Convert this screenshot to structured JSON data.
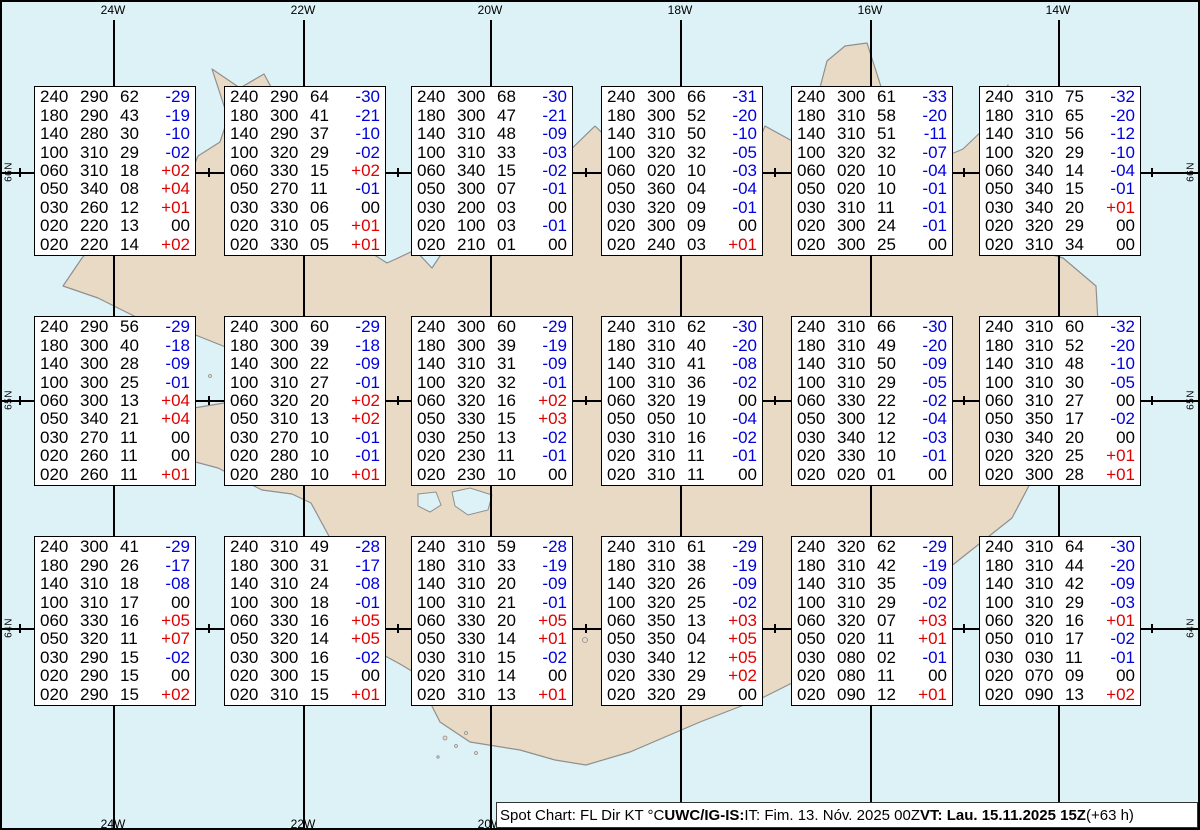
{
  "title": "Spot Chart Iceland",
  "colors": {
    "sea": "#ddf2f7",
    "land": "#e8dac5",
    "coast": "#8f8f8f",
    "grid": "#000000",
    "temp_negative": "#0000dd",
    "temp_positive": "#e00000",
    "temp_zero": "#000000"
  },
  "grid": {
    "meridians": [
      {
        "label": "24W",
        "x": 113
      },
      {
        "label": "22W",
        "x": 303
      },
      {
        "label": "20W",
        "x": 490
      },
      {
        "label": "18W",
        "x": 680
      },
      {
        "label": "16W",
        "x": 870
      },
      {
        "label": "14W",
        "x": 1058
      }
    ],
    "parallels": [
      {
        "label": "66N",
        "y": 172
      },
      {
        "label": "65N",
        "y": 400
      },
      {
        "label": "64N",
        "y": 628
      }
    ],
    "minor_tick_x": [
      19,
      208,
      397,
      585,
      774,
      963,
      1151
    ]
  },
  "columns": [
    "FL",
    "Dir",
    "KT",
    "°C"
  ],
  "boxes": [
    {
      "rows": [
        [
          "240",
          "290",
          "62",
          "-29"
        ],
        [
          "180",
          "290",
          "43",
          "-19"
        ],
        [
          "140",
          "280",
          "30",
          "-10"
        ],
        [
          "100",
          "310",
          "29",
          "-02"
        ],
        [
          "060",
          "310",
          "18",
          "+02"
        ],
        [
          "050",
          "340",
          "08",
          "+04"
        ],
        [
          "030",
          "260",
          "12",
          "+01"
        ],
        [
          "020",
          "220",
          "13",
          "00"
        ],
        [
          "020",
          "220",
          "14",
          "+02"
        ]
      ]
    },
    {
      "rows": [
        [
          "240",
          "290",
          "64",
          "-30"
        ],
        [
          "180",
          "300",
          "41",
          "-21"
        ],
        [
          "140",
          "290",
          "37",
          "-10"
        ],
        [
          "100",
          "320",
          "29",
          "-02"
        ],
        [
          "060",
          "330",
          "15",
          "+02"
        ],
        [
          "050",
          "270",
          "11",
          "-01"
        ],
        [
          "030",
          "330",
          "06",
          "00"
        ],
        [
          "020",
          "310",
          "05",
          "+01"
        ],
        [
          "020",
          "330",
          "05",
          "+01"
        ]
      ]
    },
    {
      "rows": [
        [
          "240",
          "300",
          "68",
          "-30"
        ],
        [
          "180",
          "300",
          "47",
          "-21"
        ],
        [
          "140",
          "310",
          "48",
          "-09"
        ],
        [
          "100",
          "310",
          "33",
          "-03"
        ],
        [
          "060",
          "340",
          "15",
          "-02"
        ],
        [
          "050",
          "300",
          "07",
          "-01"
        ],
        [
          "030",
          "200",
          "03",
          "00"
        ],
        [
          "020",
          "100",
          "03",
          "-01"
        ],
        [
          "020",
          "210",
          "01",
          "00"
        ]
      ]
    },
    {
      "rows": [
        [
          "240",
          "300",
          "66",
          "-31"
        ],
        [
          "180",
          "300",
          "52",
          "-20"
        ],
        [
          "140",
          "310",
          "50",
          "-10"
        ],
        [
          "100",
          "320",
          "32",
          "-05"
        ],
        [
          "060",
          "020",
          "10",
          "-03"
        ],
        [
          "050",
          "360",
          "04",
          "-04"
        ],
        [
          "030",
          "320",
          "09",
          "-01"
        ],
        [
          "020",
          "300",
          "09",
          "00"
        ],
        [
          "020",
          "240",
          "03",
          "+01"
        ]
      ]
    },
    {
      "rows": [
        [
          "240",
          "300",
          "61",
          "-33"
        ],
        [
          "180",
          "310",
          "58",
          "-20"
        ],
        [
          "140",
          "310",
          "51",
          "-11"
        ],
        [
          "100",
          "320",
          "32",
          "-07"
        ],
        [
          "060",
          "020",
          "10",
          "-04"
        ],
        [
          "050",
          "020",
          "10",
          "-01"
        ],
        [
          "030",
          "310",
          "11",
          "-01"
        ],
        [
          "020",
          "300",
          "24",
          "-01"
        ],
        [
          "020",
          "300",
          "25",
          "00"
        ]
      ]
    },
    {
      "rows": [
        [
          "240",
          "310",
          "75",
          "-32"
        ],
        [
          "180",
          "310",
          "65",
          "-20"
        ],
        [
          "140",
          "310",
          "56",
          "-12"
        ],
        [
          "100",
          "320",
          "29",
          "-10"
        ],
        [
          "060",
          "340",
          "14",
          "-04"
        ],
        [
          "050",
          "340",
          "15",
          "-01"
        ],
        [
          "030",
          "340",
          "20",
          "+01"
        ],
        [
          "020",
          "320",
          "29",
          "00"
        ],
        [
          "020",
          "310",
          "34",
          "00"
        ]
      ]
    },
    {
      "rows": [
        [
          "240",
          "290",
          "56",
          "-29"
        ],
        [
          "180",
          "300",
          "40",
          "-18"
        ],
        [
          "140",
          "300",
          "28",
          "-09"
        ],
        [
          "100",
          "300",
          "25",
          "-01"
        ],
        [
          "060",
          "300",
          "13",
          "+04"
        ],
        [
          "050",
          "340",
          "21",
          "+04"
        ],
        [
          "030",
          "270",
          "11",
          "00"
        ],
        [
          "020",
          "260",
          "11",
          "00"
        ],
        [
          "020",
          "260",
          "11",
          "+01"
        ]
      ]
    },
    {
      "rows": [
        [
          "240",
          "300",
          "60",
          "-29"
        ],
        [
          "180",
          "300",
          "39",
          "-18"
        ],
        [
          "140",
          "300",
          "22",
          "-09"
        ],
        [
          "100",
          "310",
          "27",
          "-01"
        ],
        [
          "060",
          "320",
          "20",
          "+02"
        ],
        [
          "050",
          "310",
          "13",
          "+02"
        ],
        [
          "030",
          "270",
          "10",
          "-01"
        ],
        [
          "020",
          "280",
          "10",
          "-01"
        ],
        [
          "020",
          "280",
          "10",
          "+01"
        ]
      ]
    },
    {
      "rows": [
        [
          "240",
          "300",
          "60",
          "-29"
        ],
        [
          "180",
          "300",
          "39",
          "-19"
        ],
        [
          "140",
          "310",
          "31",
          "-09"
        ],
        [
          "100",
          "320",
          "32",
          "-01"
        ],
        [
          "060",
          "320",
          "16",
          "+02"
        ],
        [
          "050",
          "330",
          "15",
          "+03"
        ],
        [
          "030",
          "250",
          "13",
          "-02"
        ],
        [
          "020",
          "230",
          "11",
          "-01"
        ],
        [
          "020",
          "230",
          "10",
          "00"
        ]
      ]
    },
    {
      "rows": [
        [
          "240",
          "310",
          "62",
          "-30"
        ],
        [
          "180",
          "310",
          "40",
          "-20"
        ],
        [
          "140",
          "310",
          "41",
          "-08"
        ],
        [
          "100",
          "310",
          "36",
          "-02"
        ],
        [
          "060",
          "320",
          "19",
          "00"
        ],
        [
          "050",
          "050",
          "10",
          "-04"
        ],
        [
          "030",
          "310",
          "16",
          "-02"
        ],
        [
          "020",
          "310",
          "11",
          "-01"
        ],
        [
          "020",
          "310",
          "11",
          "00"
        ]
      ]
    },
    {
      "rows": [
        [
          "240",
          "310",
          "66",
          "-30"
        ],
        [
          "180",
          "310",
          "49",
          "-20"
        ],
        [
          "140",
          "310",
          "50",
          "-09"
        ],
        [
          "100",
          "310",
          "29",
          "-05"
        ],
        [
          "060",
          "330",
          "22",
          "-02"
        ],
        [
          "050",
          "300",
          "12",
          "-04"
        ],
        [
          "030",
          "340",
          "12",
          "-03"
        ],
        [
          "020",
          "330",
          "10",
          "-01"
        ],
        [
          "020",
          "020",
          "01",
          "00"
        ]
      ]
    },
    {
      "rows": [
        [
          "240",
          "310",
          "60",
          "-32"
        ],
        [
          "180",
          "310",
          "52",
          "-20"
        ],
        [
          "140",
          "310",
          "48",
          "-10"
        ],
        [
          "100",
          "310",
          "30",
          "-05"
        ],
        [
          "060",
          "310",
          "27",
          "00"
        ],
        [
          "050",
          "350",
          "17",
          "-02"
        ],
        [
          "030",
          "340",
          "20",
          "00"
        ],
        [
          "020",
          "320",
          "25",
          "+01"
        ],
        [
          "020",
          "300",
          "28",
          "+01"
        ]
      ]
    },
    {
      "rows": [
        [
          "240",
          "300",
          "41",
          "-29"
        ],
        [
          "180",
          "290",
          "26",
          "-17"
        ],
        [
          "140",
          "310",
          "18",
          "-08"
        ],
        [
          "100",
          "310",
          "17",
          "00"
        ],
        [
          "060",
          "330",
          "16",
          "+05"
        ],
        [
          "050",
          "320",
          "11",
          "+07"
        ],
        [
          "030",
          "290",
          "15",
          "-02"
        ],
        [
          "020",
          "290",
          "15",
          "00"
        ],
        [
          "020",
          "290",
          "15",
          "+02"
        ]
      ]
    },
    {
      "rows": [
        [
          "240",
          "310",
          "49",
          "-28"
        ],
        [
          "180",
          "300",
          "31",
          "-17"
        ],
        [
          "140",
          "310",
          "24",
          "-08"
        ],
        [
          "100",
          "300",
          "18",
          "-01"
        ],
        [
          "060",
          "330",
          "16",
          "+05"
        ],
        [
          "050",
          "320",
          "14",
          "+05"
        ],
        [
          "030",
          "300",
          "16",
          "-02"
        ],
        [
          "020",
          "300",
          "15",
          "00"
        ],
        [
          "020",
          "310",
          "15",
          "+01"
        ]
      ]
    },
    {
      "rows": [
        [
          "240",
          "310",
          "59",
          "-28"
        ],
        [
          "180",
          "310",
          "33",
          "-19"
        ],
        [
          "140",
          "310",
          "20",
          "-09"
        ],
        [
          "100",
          "310",
          "21",
          "-01"
        ],
        [
          "060",
          "330",
          "20",
          "+05"
        ],
        [
          "050",
          "330",
          "14",
          "+01"
        ],
        [
          "030",
          "310",
          "15",
          "-02"
        ],
        [
          "020",
          "310",
          "14",
          "00"
        ],
        [
          "020",
          "310",
          "13",
          "+01"
        ]
      ]
    },
    {
      "rows": [
        [
          "240",
          "310",
          "61",
          "-29"
        ],
        [
          "180",
          "310",
          "38",
          "-19"
        ],
        [
          "140",
          "320",
          "26",
          "-09"
        ],
        [
          "100",
          "320",
          "25",
          "-02"
        ],
        [
          "060",
          "350",
          "13",
          "+03"
        ],
        [
          "050",
          "350",
          "04",
          "+05"
        ],
        [
          "030",
          "340",
          "12",
          "+05"
        ],
        [
          "020",
          "330",
          "29",
          "+02"
        ],
        [
          "020",
          "320",
          "29",
          "00"
        ]
      ]
    },
    {
      "rows": [
        [
          "240",
          "320",
          "62",
          "-29"
        ],
        [
          "180",
          "310",
          "42",
          "-19"
        ],
        [
          "140",
          "310",
          "35",
          "-09"
        ],
        [
          "100",
          "310",
          "29",
          "-02"
        ],
        [
          "060",
          "320",
          "07",
          "+03"
        ],
        [
          "050",
          "020",
          "11",
          "+01"
        ],
        [
          "030",
          "080",
          "02",
          "-01"
        ],
        [
          "020",
          "080",
          "11",
          "00"
        ],
        [
          "020",
          "090",
          "12",
          "+01"
        ]
      ]
    },
    {
      "rows": [
        [
          "240",
          "310",
          "64",
          "-30"
        ],
        [
          "180",
          "310",
          "44",
          "-20"
        ],
        [
          "140",
          "310",
          "42",
          "-09"
        ],
        [
          "100",
          "310",
          "29",
          "-03"
        ],
        [
          "060",
          "320",
          "16",
          "+01"
        ],
        [
          "050",
          "010",
          "17",
          "-02"
        ],
        [
          "030",
          "030",
          "11",
          "-01"
        ],
        [
          "020",
          "070",
          "09",
          "00"
        ],
        [
          "020",
          "090",
          "13",
          "+02"
        ]
      ]
    }
  ],
  "legend": {
    "segments": [
      {
        "text": "Spot Chart: FL Dir KT °C ",
        "bold": false
      },
      {
        "text": "UWC/IG-IS:",
        "bold": true
      },
      {
        "text": " IT: Fim. 13. Nóv. 2025 00Z ",
        "bold": false
      },
      {
        "text": "VT: Lau. 15.11.2025 15Z",
        "bold": true
      },
      {
        "text": " (+63 h)",
        "bold": false
      }
    ]
  }
}
